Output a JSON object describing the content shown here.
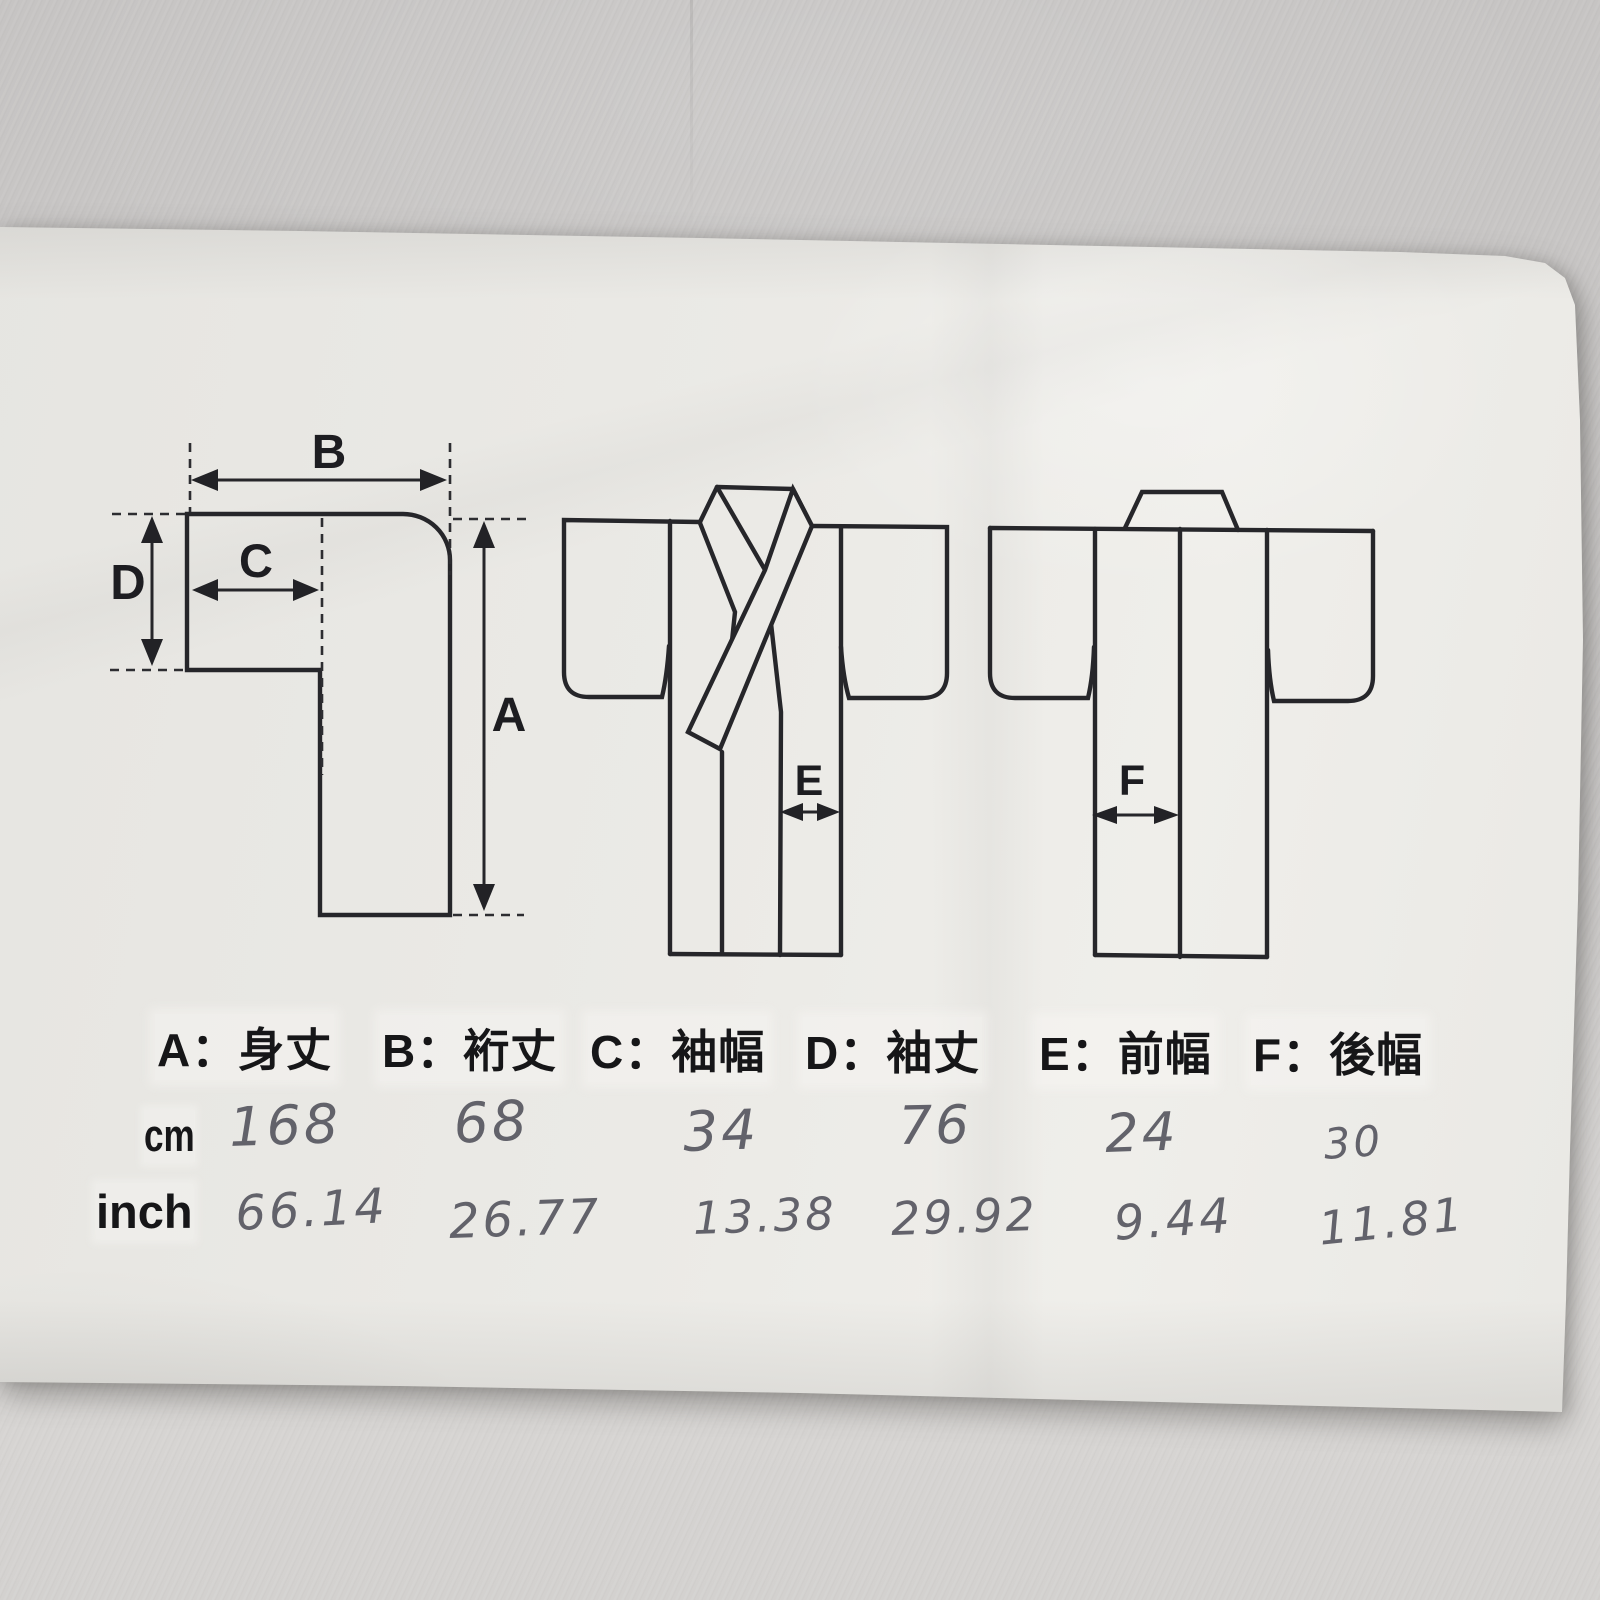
{
  "ui": {
    "colon": "：",
    "cm_label": "cm",
    "inch_label": "inch"
  },
  "measurements": [
    {
      "letter": "A",
      "term": "身丈",
      "cm": "168",
      "inch": "66.14"
    },
    {
      "letter": "B",
      "term": "裄丈",
      "cm": "68",
      "inch": "26.77"
    },
    {
      "letter": "C",
      "term": "袖幅",
      "cm": "34",
      "inch": "13.38"
    },
    {
      "letter": "D",
      "term": "袖丈",
      "cm": "76",
      "inch": "29.92"
    },
    {
      "letter": "E",
      "term": "前幅",
      "cm": "24",
      "inch": "9.44"
    },
    {
      "letter": "F",
      "term": "後幅",
      "cm": "30",
      "inch": "11.81"
    }
  ]
}
